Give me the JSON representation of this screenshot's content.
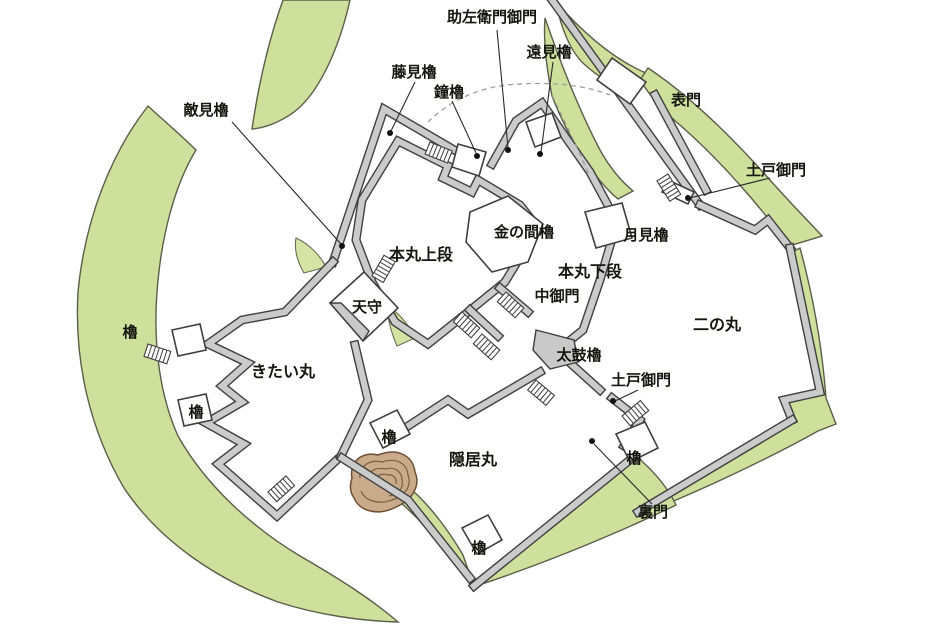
{
  "map": {
    "kind": "hand-drawn castle grounds plan",
    "colors": {
      "moat_green": "#cfe09c",
      "wall_gray": "#c9c9c9",
      "outline": "#3f3f3f",
      "mound_tan": "#c9ab8b",
      "background": "#ffffff"
    }
  },
  "labels": {
    "sukezaemon_gomon": "助左衛門御門",
    "tomi_yagura": "遠見櫓",
    "fujimi_yagura": "藤見櫓",
    "kane_yagura": "鐘櫓",
    "tekimi_yagura": "敵見櫓",
    "omote_mon": "表門",
    "todo_gomon_upper": "土戸御門",
    "kin_no_ma_yagura": "金の間櫓",
    "tsukimi_yagura": "月見櫓",
    "honmaru_joudan": "本丸上段",
    "honmaru_gedan": "本丸下段",
    "naka_gomon": "中御門",
    "ninomaru": "二の丸",
    "tenshu": "天守",
    "yagura_left_upper": "櫓",
    "kitai_maru": "きたい丸",
    "taiko_yagura": "太鼓櫓",
    "todo_gomon_lower": "土戸御門",
    "yagura_left_lower": "櫓",
    "yagura_inkyo_nw": "櫓",
    "inkyo_maru": "隠居丸",
    "yagura_ninomaru_s": "櫓",
    "ura_mon": "裏門",
    "yagura_inkyo_s": "櫓"
  }
}
